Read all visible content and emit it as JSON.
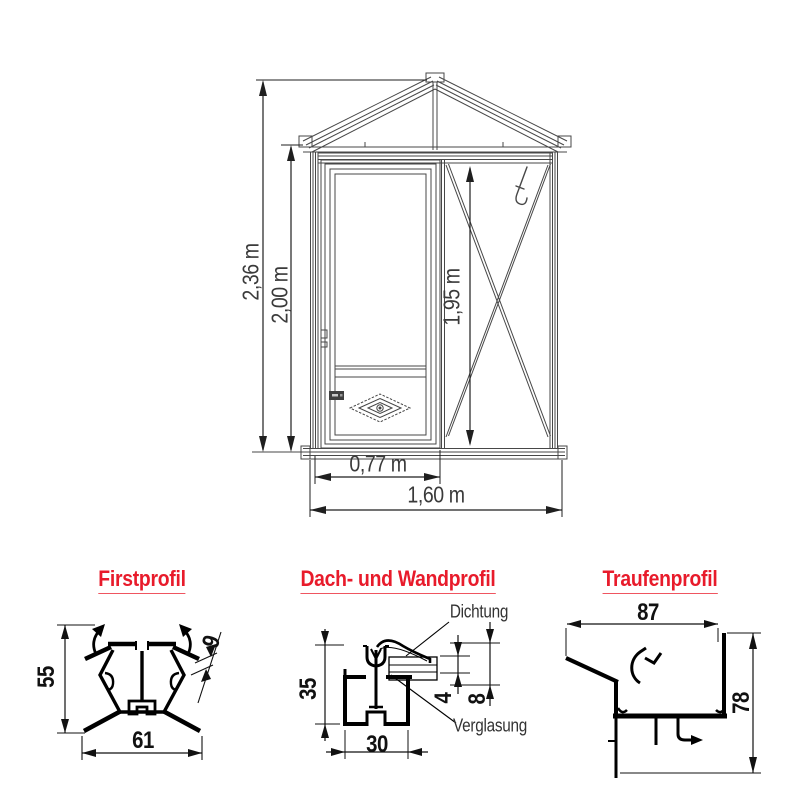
{
  "page": {
    "background": "#ffffff",
    "accent_red": "#e81b2b",
    "drawing_line_color": "#474747",
    "profile_line_color": "#000000"
  },
  "elevation": {
    "dimensions": {
      "total_height": "2,36 m",
      "side_height": "2,00 m",
      "door_height": "1,95 m",
      "door_width": "0,77 m",
      "total_width": "1,60 m"
    }
  },
  "profiles": {
    "ridge": {
      "title": "Firstprofil",
      "height": "55",
      "width": "61",
      "thickness": "9"
    },
    "roof_wall": {
      "title": "Dach- und Wandprofil",
      "height": "35",
      "width": "30",
      "glazing_single": "4",
      "glazing_double": "8",
      "seal_label": "Dichtung",
      "glazing_label": "Verglasung"
    },
    "eaves": {
      "title": "Traufenprofil",
      "width": "87",
      "height": "78"
    }
  }
}
